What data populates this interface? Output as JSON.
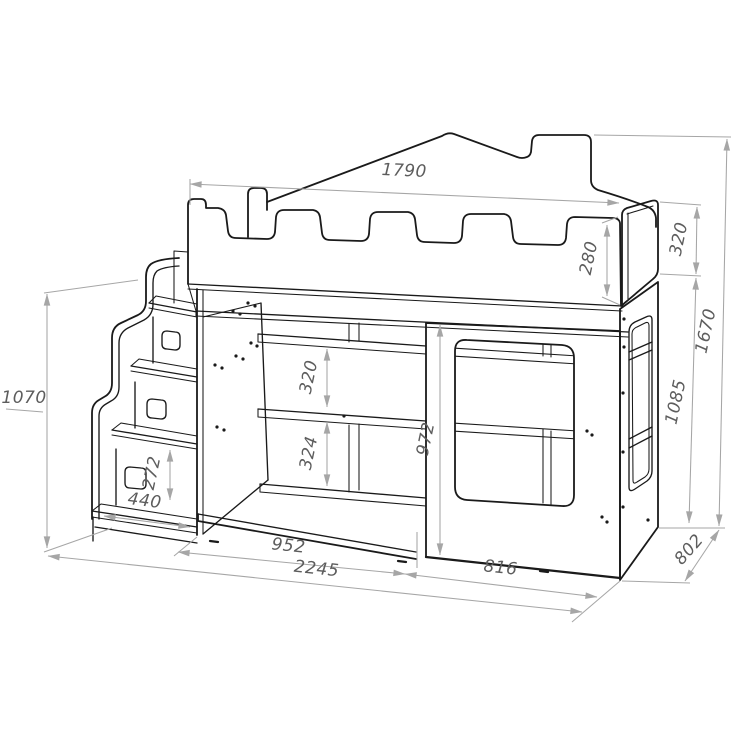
{
  "drawing": {
    "dimensions": {
      "bed_length_top": "1790",
      "guard_rail_height": "280",
      "side_rail_height": "320",
      "overall_height": "1670",
      "side_panel_height": "1085",
      "overall_depth": "802",
      "stairs_height": "1070",
      "shelf_gap_upper": "320",
      "shelf_gap_lower": "324",
      "opening_height": "972",
      "step_rise": "272",
      "bottom_step_width": "440",
      "open_section_width": "952",
      "overall_length": "2245",
      "window_section_width": "816"
    },
    "colors": {
      "outline": "#1a1a1a",
      "dimension_line": "#a6a6a6",
      "dimension_text": "#5d5d5d",
      "background": "#ffffff"
    }
  }
}
